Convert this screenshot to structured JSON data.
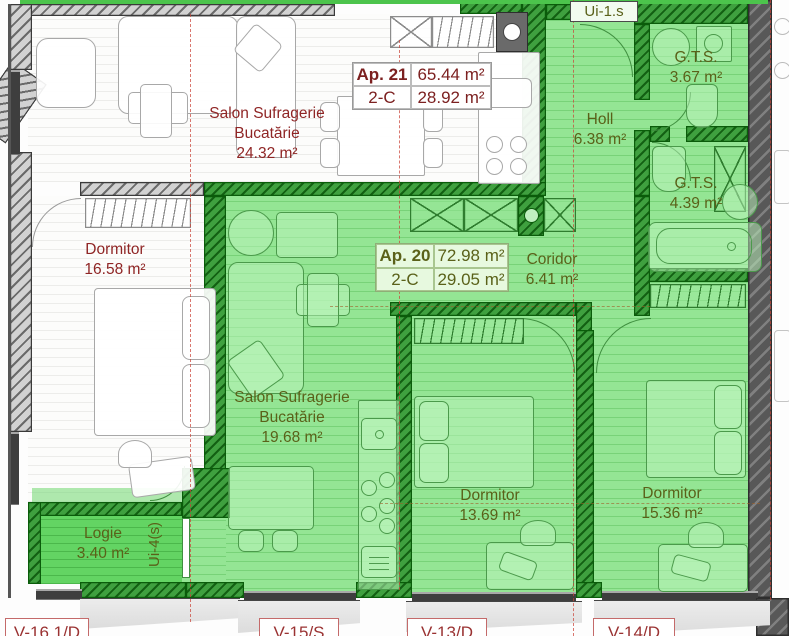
{
  "apartments": {
    "ap21": {
      "name": "Ap. 21",
      "type": "2-C",
      "total_area": "65.44 m²",
      "living_area": "28.92 m²"
    },
    "ap20": {
      "name": "Ap. 20",
      "type": "2-C",
      "total_area": "72.98 m²",
      "living_area": "29.05 m²"
    }
  },
  "rooms": {
    "salon21": {
      "name_line1": "Salon Sufragerie",
      "name_line2": "Bucatărie",
      "area": "24.32 m²"
    },
    "dormitor21": {
      "name": "Dormitor",
      "area": "16.58 m²"
    },
    "holl": {
      "name": "Holl",
      "area": "6.38 m²"
    },
    "gts_upper": {
      "name": "G.T.S.",
      "area": "3.67 m²"
    },
    "gts_lower": {
      "name": "G.T.S.",
      "area": "4.39 m²"
    },
    "coridor": {
      "name": "Coridor",
      "area": "6.41 m²"
    },
    "salon20": {
      "name_line1": "Salon Sufragerie",
      "name_line2": "Bucatărie",
      "area": "19.68 m²"
    },
    "dormitor20a": {
      "name": "Dormitor",
      "area": "13.69 m²"
    },
    "dormitor20b": {
      "name": "Dormitor",
      "area": "15.36 m²"
    },
    "logie": {
      "name": "Logie",
      "area": "3.40 m²"
    }
  },
  "doors": {
    "entrance_ap20": "Ui-1.s",
    "logie_door": "Ui-4(s)"
  },
  "windows": {
    "w16": "V-16.1/D",
    "w15": "V-15/S",
    "w13": "V-13/D",
    "w14": "V-14/D"
  },
  "colors": {
    "highlight_green": "#94e594",
    "bright_green": "#63d463",
    "wall_green": "#3fa03f",
    "wall_gray": "#d2d2d2",
    "dark_wall": "#585858",
    "label_red": "#8f2525",
    "label_olive": "#5a6119",
    "window_label_red": "#9a3232",
    "centerline_red": "#ca4238"
  }
}
